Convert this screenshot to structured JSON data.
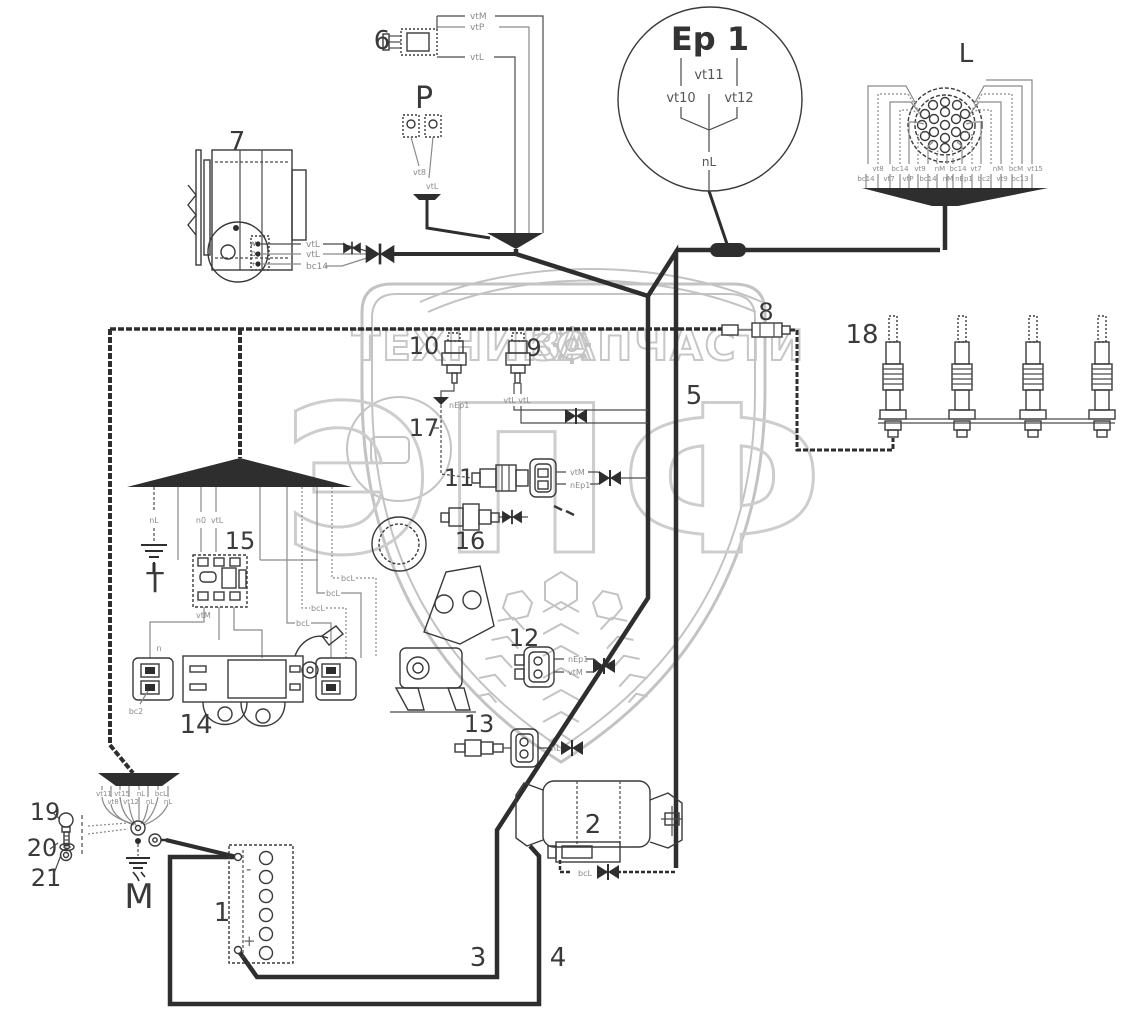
{
  "watermark": {
    "left": "ТЕХНИКА",
    "right": "ЗАПЧАСТИ",
    "logo": "ЭПФ"
  },
  "callouts": {
    "n1": "1",
    "n2": "2",
    "n3": "3",
    "n4": "4",
    "n5": "5",
    "n6": "6",
    "n7": "7",
    "n8": "8",
    "n9": "9",
    "n10": "10",
    "n11": "11",
    "n12": "12",
    "n13": "13",
    "n14": "14",
    "n15": "15",
    "n16": "16",
    "n17": "17",
    "n18": "18",
    "n19": "19",
    "n20": "20",
    "n21": "21",
    "P": "P",
    "T": "T",
    "M": "M",
    "L": "L"
  },
  "ep1": {
    "title": "Ep 1",
    "t10": "vt10",
    "t11": "vt11",
    "t12": "vt12",
    "out": "nL"
  },
  "battery": {
    "neg": "-",
    "pos": "+"
  },
  "alt": {
    "t1": "W",
    "t2": "D",
    "t3": "+",
    "w1": "vtL",
    "w2": "vtL",
    "w3": "bc14"
  },
  "w": {
    "c6_1": "vtM",
    "c6_2": "vtP",
    "c6_3": "vtL",
    "p_1": "vt8",
    "p_2": "vtL",
    "s10": "nEp1",
    "s9": "vtL vtL",
    "s11_1": "vtM",
    "s11_2": "nEp1",
    "c12_1": "nEp1",
    "c12_2": "vtM",
    "c13": "nL",
    "st": "bcL",
    "fanL_1": "nL",
    "fanL_2": "n0",
    "fanL_3": "vtL",
    "bcl1": "bcL",
    "bcl2": "bcL",
    "bcl3": "bcL",
    "bcl4": "bcL",
    "r15": "vtM",
    "c14_1": "n",
    "c14_2": "bc2",
    "fb_r1": [
      "vt11",
      "vt15",
      "nL",
      "bcL"
    ],
    "fb_r2": [
      "vt8",
      "vt12",
      "nL",
      "nL"
    ],
    "L_r1": [
      "vt8",
      "bc14",
      "vt9",
      "nM",
      "bc14",
      "vt7",
      "nM",
      "bcM",
      "vt15"
    ],
    "L_r2": [
      "bc14",
      "vt7",
      "vtP",
      "bc14",
      "nM",
      "nEp1",
      "bc2",
      "vt9",
      "bc13"
    ]
  }
}
